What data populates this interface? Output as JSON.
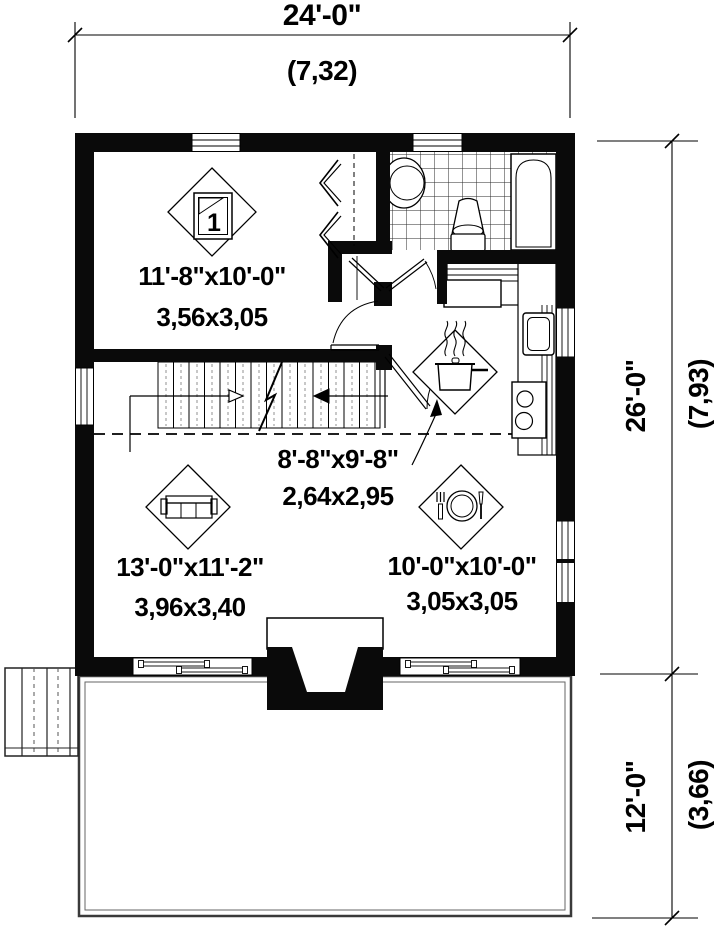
{
  "plan": {
    "bedroom_number": "1",
    "rooms": {
      "bedroom": {
        "imperial": "11'-8\"x10'-0\"",
        "metric": "3,56x3,05"
      },
      "hall": {
        "imperial": "8'-8\"x9'-8\"",
        "metric": "2,64x2,95"
      },
      "living": {
        "imperial": "13'-0\"x11'-2\"",
        "metric": "3,96x3,40"
      },
      "dining": {
        "imperial": "10'-0\"x10'-0\"",
        "metric": "3,05x3,05"
      }
    },
    "dimensions": {
      "overall_width": {
        "imperial": "24'-0\"",
        "metric": "(7,32)"
      },
      "main_depth": {
        "imperial": "26'-0\"",
        "metric": "(7,93)"
      },
      "deck_depth": {
        "imperial": "12'-0\"",
        "metric": "(3,66)"
      }
    },
    "colors": {
      "wall": "#0a0a0a",
      "line": "#000000",
      "background": "#ffffff",
      "deck_edge": "#3a3a3a"
    }
  }
}
